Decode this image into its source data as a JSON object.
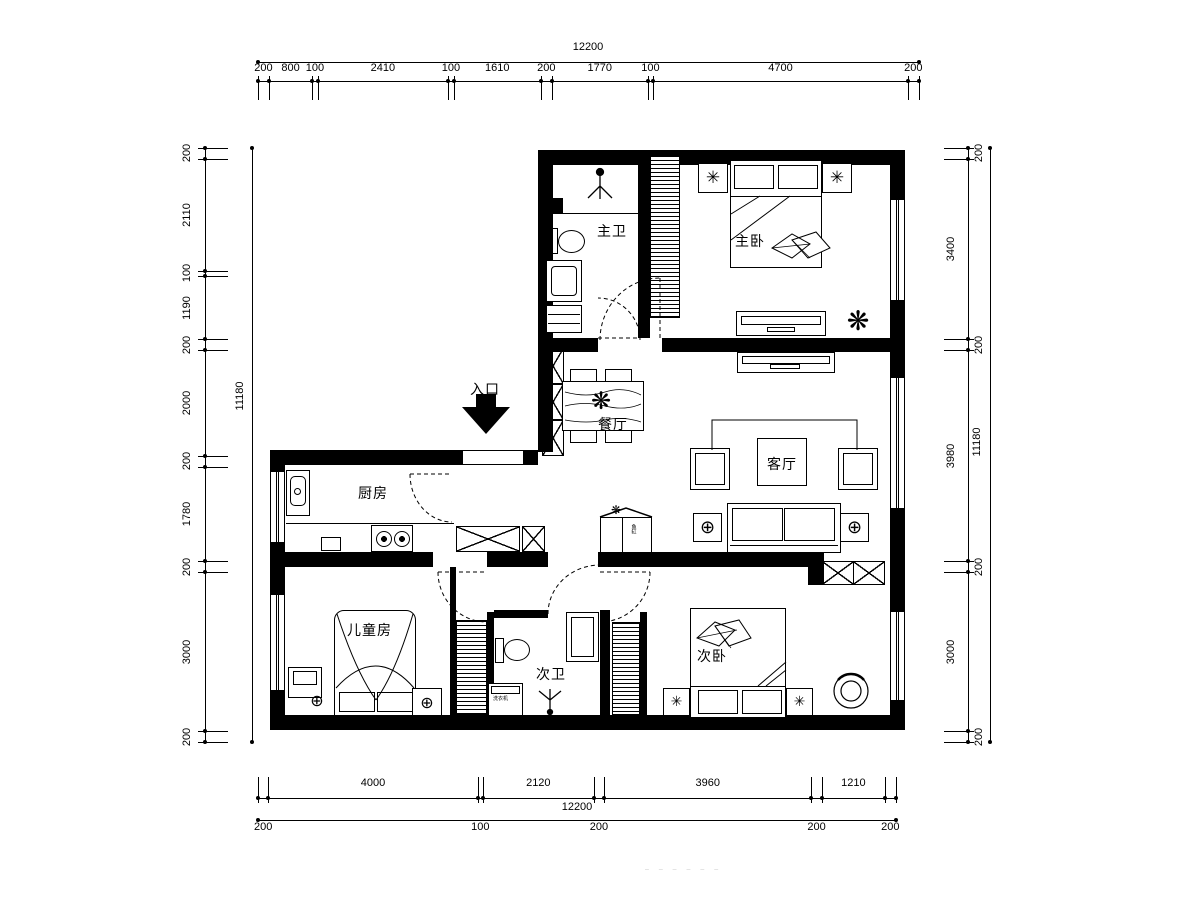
{
  "plan": {
    "rooms": [
      {
        "id": "master-bath",
        "label": "主卫"
      },
      {
        "id": "master-bedroom",
        "label": "主卧"
      },
      {
        "id": "dining",
        "label": "餐厅"
      },
      {
        "id": "living",
        "label": "客厅"
      },
      {
        "id": "kitchen",
        "label": "厨房"
      },
      {
        "id": "kids-room",
        "label": "儿童房"
      },
      {
        "id": "second-bath",
        "label": "次卫"
      },
      {
        "id": "second-bedroom",
        "label": "次卧"
      }
    ],
    "entrance_label": "入口",
    "washer_label": "洗衣机",
    "cabinet_label": "鱼缸",
    "watermark": "– – – – – –"
  },
  "dimensions": {
    "top": {
      "total": "12200",
      "segments": [
        200,
        800,
        100,
        2410,
        100,
        1610,
        200,
        1770,
        100,
        4700,
        200
      ]
    },
    "bottom": {
      "total": "12200",
      "segments": [
        200,
        4000,
        100,
        2120,
        200,
        3960,
        200,
        1210,
        200
      ]
    },
    "left": {
      "total": "11180",
      "segments": [
        200,
        2110,
        100,
        1190,
        200,
        2000,
        200,
        1780,
        200,
        3000,
        200
      ]
    },
    "right": {
      "total": "11180",
      "segments": [
        200,
        3400,
        200,
        3980,
        200,
        3000,
        200
      ]
    }
  }
}
